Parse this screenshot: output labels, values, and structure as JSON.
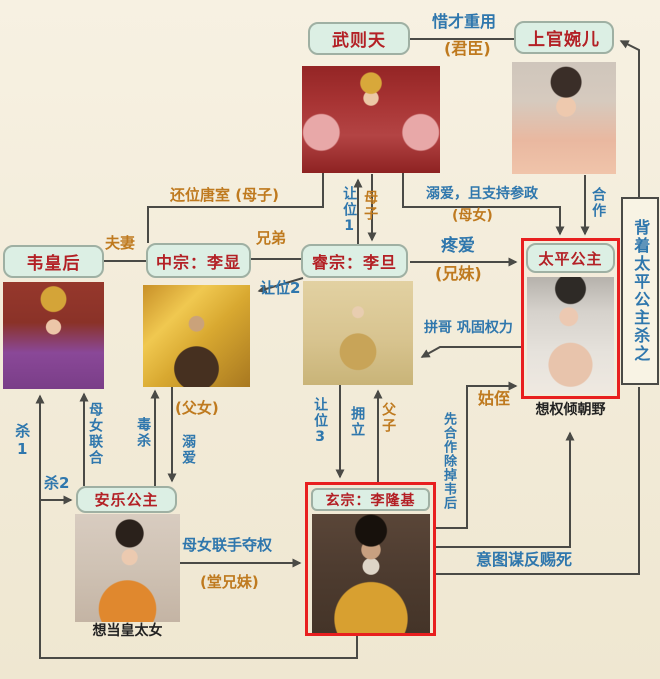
{
  "canvas": {
    "width": 660,
    "height": 679
  },
  "colors": {
    "background": "#f3ecda",
    "node_fill": "#dcefe4",
    "node_border": "#9fb0a3",
    "node_text": "#b32025",
    "blue_label": "#2f77ad",
    "orange_label": "#bf7a1f",
    "line": "#4a4a46",
    "highlight_border": "#e81f1f"
  },
  "nodes": {
    "wuzetian": {
      "label": "武则天"
    },
    "shangguanwaner": {
      "label": "上官婉儿"
    },
    "weihuanghou": {
      "label": "韦皇后"
    },
    "zhongzong": {
      "label": "中宗：李显"
    },
    "ruizong": {
      "label": "睿宗：李旦"
    },
    "taiping": {
      "label": "太平公主",
      "caption": "想权倾朝野"
    },
    "anle": {
      "label": "安乐公主",
      "caption": "想当皇太女"
    },
    "xuanzong": {
      "label": "玄宗：李隆基"
    }
  },
  "edge_labels": {
    "xicai_zhongyong": "惜才重用",
    "junchen": "(君臣)",
    "huanwei_tangshi": "还位唐室 (母子)",
    "rangwei1": "让位1",
    "muzi": "母子",
    "niai_canzheng": "溺爱，且支持参政",
    "munv": "(母女)",
    "hezuo": "合作",
    "beizhe_sha": "背着太平公主杀之",
    "fuqi": "夫妻",
    "xiongdi": "兄弟",
    "tengai": "疼爱",
    "xiongmei": "(兄妹)",
    "rangwei2": "让位2",
    "pingge_gonggu": "拼哥 巩固权力",
    "guzhi": "姑侄",
    "sha1": "杀1",
    "sha2": "杀2",
    "munv_lianhe": "母女联合",
    "dusha": "毒杀",
    "funv": "(父女)",
    "niai": "溺爱",
    "rangwei3": "让位3",
    "yongli": "拥立",
    "fuzi": "父子",
    "xian_hezuo_chudiao_weihou": "先合作除掉韦后",
    "munv_lianshou_duoquan": "母女联手夺权",
    "tangxiongmei": "(堂兄妹)",
    "yitu_moufan_cisi": "意图谋反赐死"
  }
}
